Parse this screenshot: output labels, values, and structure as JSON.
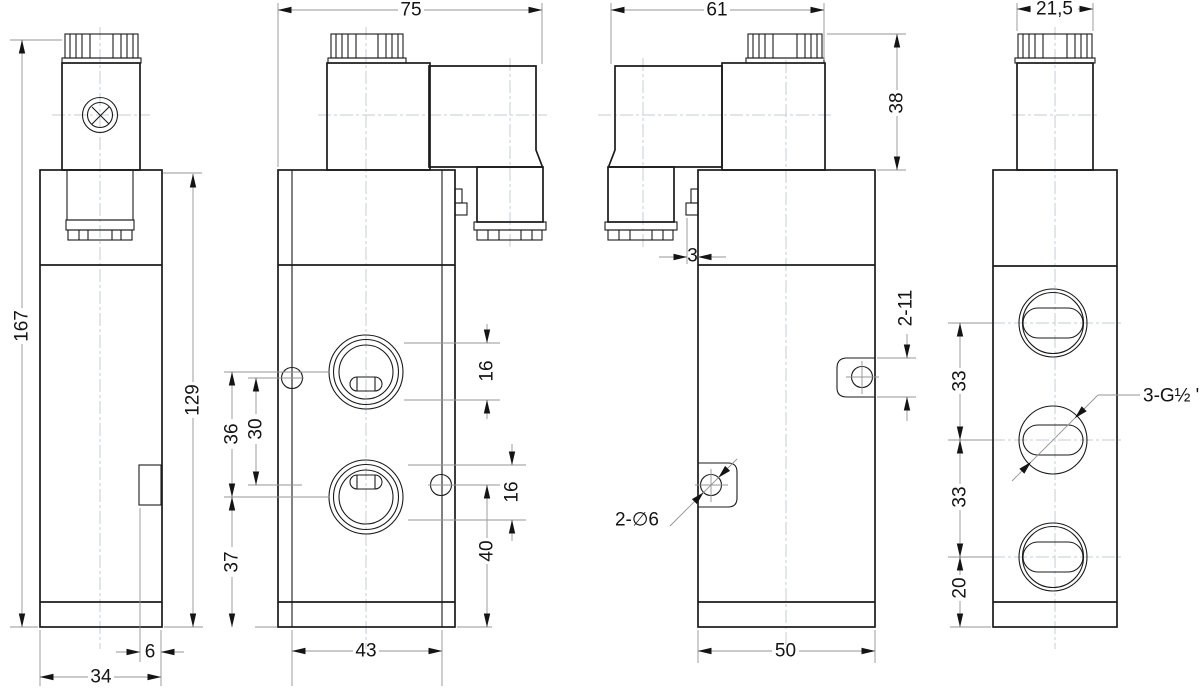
{
  "drawing": {
    "kind": "valve-dimensional-drawing",
    "background_color": "#ffffff",
    "object_line_color": "#1b1b1b",
    "dimension_line_color": "#949494",
    "centerline_color": "#c7ccd1",
    "text_color": "#141414"
  },
  "dims": {
    "side": {
      "total_height": "167",
      "body_height": "129",
      "depth": "34",
      "lug_depth": "6"
    },
    "front": {
      "overall_width": "75",
      "port_pitch": "36",
      "hole_pitch": "30",
      "port_to_base": "37",
      "bore_top": "16",
      "bore_bottom": "16",
      "hole_to_base": "40",
      "hole_span": "43"
    },
    "back": {
      "overall_width": "61",
      "solenoid_height": "38",
      "bracket_thickness": "3",
      "lug_length": "2-11",
      "lug_holes": "2-∅6",
      "body_width": "50"
    },
    "right": {
      "cap_width": "21,5",
      "port_pitch_upper": "33",
      "port_pitch_lower": "33",
      "port_to_base": "20",
      "thread_callout": "3-G½ \""
    }
  }
}
